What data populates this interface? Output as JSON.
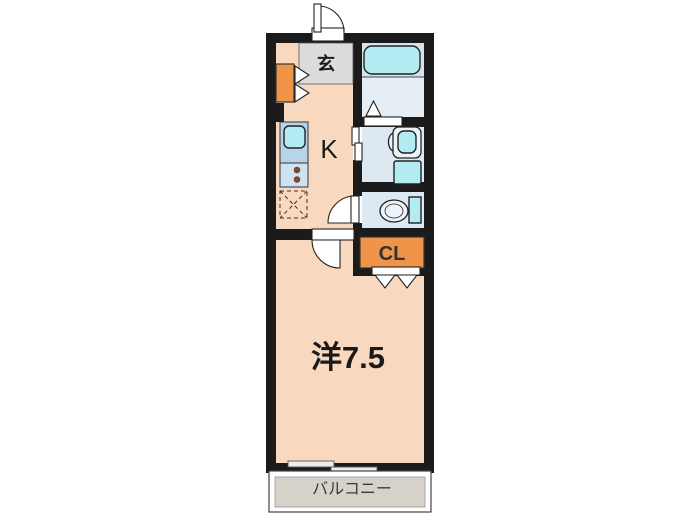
{
  "floorplan": {
    "rooms": {
      "entrance": {
        "label": "玄"
      },
      "kitchen": {
        "label": "K"
      },
      "closet": {
        "label": "CL"
      },
      "western_room": {
        "label": "洋7.5"
      },
      "balcony": {
        "label": "バルコニー"
      }
    },
    "fixtures": [
      "entrance-door",
      "shoe-cabinet",
      "shoe-cabinet-folding-door",
      "kitchen-sink",
      "gas-stove",
      "refrigerator-space",
      "bathtub",
      "bath-door",
      "washbasin",
      "washing-machine",
      "washroom-sliding-door",
      "toilet",
      "toilet-door",
      "room-door",
      "closet-folding-door",
      "sliding-window",
      "balcony-rail"
    ],
    "palette": {
      "wall": "#1b1b1b",
      "room": "#f8d9c0",
      "entrance_gray": "#dcdcdc",
      "storage_orange": "#ef9449",
      "wet_area": "#dce8f2",
      "bath": "#d5e3ec",
      "bath_floor": "#e4eef4",
      "fixture_cyan": "#b2ecf2",
      "counter_blue": "#b9d3e9",
      "stove_blue": "#cfe2f2",
      "balcony_gray": "#d6d2ca",
      "outline": "#222222"
    }
  }
}
